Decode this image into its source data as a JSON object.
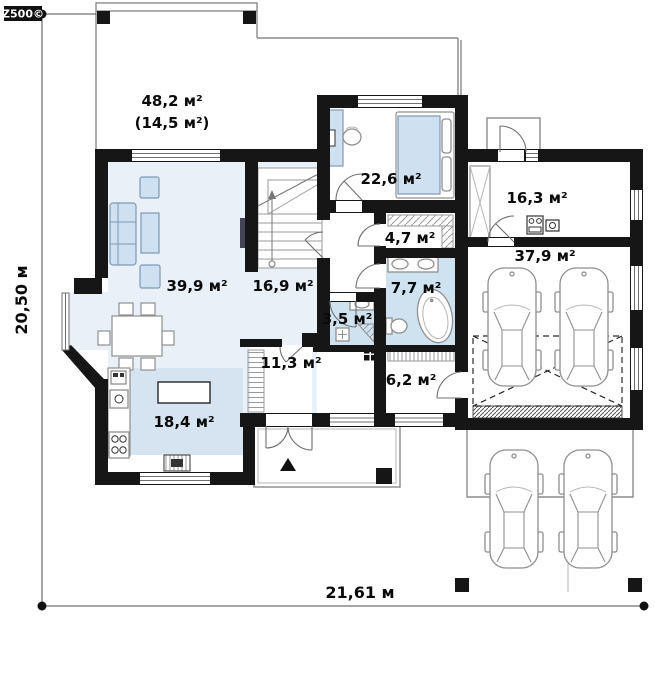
{
  "logo": {
    "text": "Z500©"
  },
  "dimensions": {
    "horizontal": "21,61 м",
    "vertical": "20,50 м"
  },
  "rooms": {
    "terrace": {
      "area": "48,2 м²",
      "area_secondary": "(14,5 м²)"
    },
    "living_room": {
      "area": "39,9 м²"
    },
    "hall": {
      "area": "16,9 м²"
    },
    "kitchen": {
      "area": "18,4 м²"
    },
    "corridor": {
      "area": "11,3 м²"
    },
    "vestibule": {
      "area": "6,2 м²"
    },
    "wc": {
      "area": "3,5 м²"
    },
    "bathroom": {
      "area": "7,7 м²"
    },
    "wardrobe": {
      "area": "4,7 м²"
    },
    "bedroom": {
      "area": "22,6 м²"
    },
    "utility_room": {
      "area": "16,3 м²"
    },
    "garage": {
      "area": "37,9 м²"
    }
  },
  "colors": {
    "wall": "#161616",
    "room_tint_light": "#e9f0f8",
    "room_tint_wet": "#d6e4f2",
    "furniture": "#cfe0f0",
    "outline": "#8a8a8a"
  }
}
